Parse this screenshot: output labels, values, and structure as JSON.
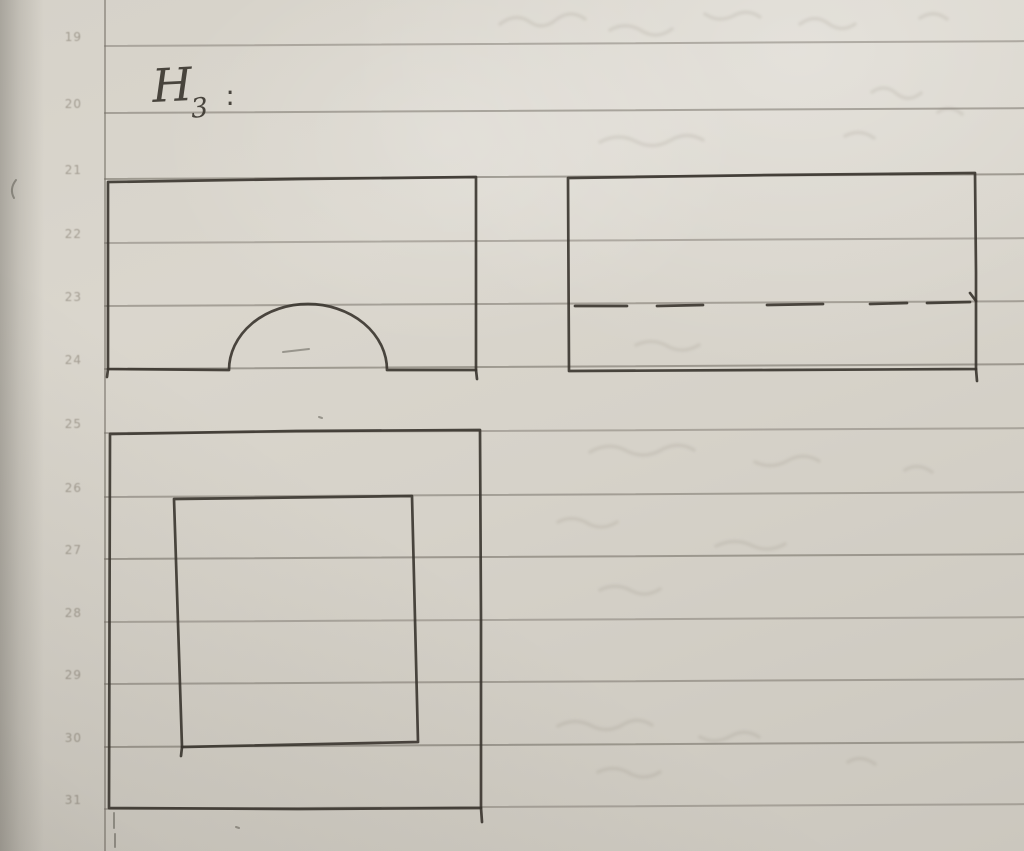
{
  "header": {
    "letter": "H",
    "subscript": "3",
    "colon": ":"
  },
  "margin": {
    "numbers": [
      "19",
      "20",
      "21",
      "22",
      "23",
      "24",
      "25",
      "26",
      "27",
      "28",
      "29",
      "30",
      "31"
    ]
  },
  "colors": {
    "paper": "#d6d2c9",
    "ruled_line": "#7d786f",
    "margin_digits": "#776f62",
    "ink": "#38342e"
  },
  "figures": {
    "front_view": {
      "description": "rectangle with semicircular arch notch in bottom edge",
      "strokes": [
        {
          "style": "pen",
          "path": "M108,182 L300,179 L476,177 L476,272 L476,370 L387,370 A79,66 0 0 0 229,370 L108,369 Z"
        },
        {
          "style": "pen",
          "path": "M108,369 L107,377"
        },
        {
          "style": "pen",
          "path": "M476,370 L477,379"
        }
      ]
    },
    "side_view": {
      "description": "rectangle with horizontal dashed hidden line",
      "strokes": [
        {
          "style": "pen",
          "path": "M568,178 L772,175 L975,173 L976,272 L976,369 L770,370 L569,371 Z"
        },
        {
          "style": "pen",
          "path": "M575,306 L627,306"
        },
        {
          "style": "pen",
          "path": "M657,306 L703,305"
        },
        {
          "style": "pen",
          "path": "M767,305 L823,304"
        },
        {
          "style": "pen",
          "path": "M870,304 L907,303"
        },
        {
          "style": "pen",
          "path": "M927,303 L970,302"
        },
        {
          "style": "pen",
          "path": "M970,293 L976,301"
        },
        {
          "style": "pen",
          "path": "M976,369 L977,381"
        }
      ]
    },
    "top_view": {
      "description": "large square with smaller square inside",
      "strokes": [
        {
          "style": "pen",
          "path": "M110,434 L296,431 L480,430 L481,620 L481,808 L298,809 L109,808 Z"
        },
        {
          "style": "pen",
          "path": "M481,808 L482,822"
        },
        {
          "style": "pen",
          "path": "M174,499 L412,496 L418,742 L182,747 Z"
        },
        {
          "style": "pen",
          "path": "M182,747 L181,756"
        }
      ]
    },
    "stray_marks": {
      "description": "small stray pen dots and ticks",
      "strokes": [
        {
          "style": "pen-light",
          "path": "M319,417 L322,418"
        },
        {
          "style": "pen-light",
          "path": "M236,827 L239,828"
        },
        {
          "style": "pen-light",
          "path": "M114,813 L114,828"
        },
        {
          "style": "pen-light",
          "path": "M115,834 L115,847"
        },
        {
          "style": "pen-light",
          "path": "M16,180 Q9,189 14,198"
        },
        {
          "style": "pen-light",
          "path": "M283,352 L309,349"
        }
      ]
    }
  },
  "ghost_marks": {
    "description": "illegible ink bleed-through from reverse side",
    "strokes": [
      {
        "path": "M500,24 q16,-12 30,-2 q13,9 27,-3 q14,-10 28,0"
      },
      {
        "path": "M610,30 q16,-9 32,1 q15,9 30,-2"
      },
      {
        "path": "M705,14 q13,9 28,2 q14,-8 27,1"
      },
      {
        "path": "M800,24 q15,-11 29,0 q13,9 26,0"
      },
      {
        "path": "M920,18 q14,-9 27,1"
      },
      {
        "path": "M872,92 q13,-9 25,2 q12,9 24,-1"
      },
      {
        "path": "M938,112 q12,-8 24,2"
      },
      {
        "path": "M600,142 q19,-10 37,0 q17,8 34,-2 q16,-9 32,0"
      },
      {
        "path": "M845,136 q15,-8 29,2"
      },
      {
        "path": "M636,345 q17,-8 33,2 q15,7 30,-2"
      },
      {
        "path": "M590,452 q19,-11 37,-1 q18,9 36,-2 q16,-8 31,1"
      },
      {
        "path": "M755,462 q17,8 34,-2 q15,-8 30,1"
      },
      {
        "path": "M905,470 q13,-8 27,2"
      },
      {
        "path": "M558,522 q15,-8 31,2 q14,7 28,-2"
      },
      {
        "path": "M716,546 q19,-9 37,0 q16,7 32,-2"
      },
      {
        "path": "M600,590 q16,-8 32,1 q14,7 28,-2"
      },
      {
        "path": "M558,726 q17,-9 34,0 q16,8 32,-2 q14,-8 28,1"
      },
      {
        "path": "M700,737 q15,8 31,-1 q14,-8 28,1"
      },
      {
        "path": "M598,772 q17,-8 33,2 q14,7 29,-2"
      },
      {
        "path": "M848,762 q13,-8 27,2"
      }
    ]
  }
}
